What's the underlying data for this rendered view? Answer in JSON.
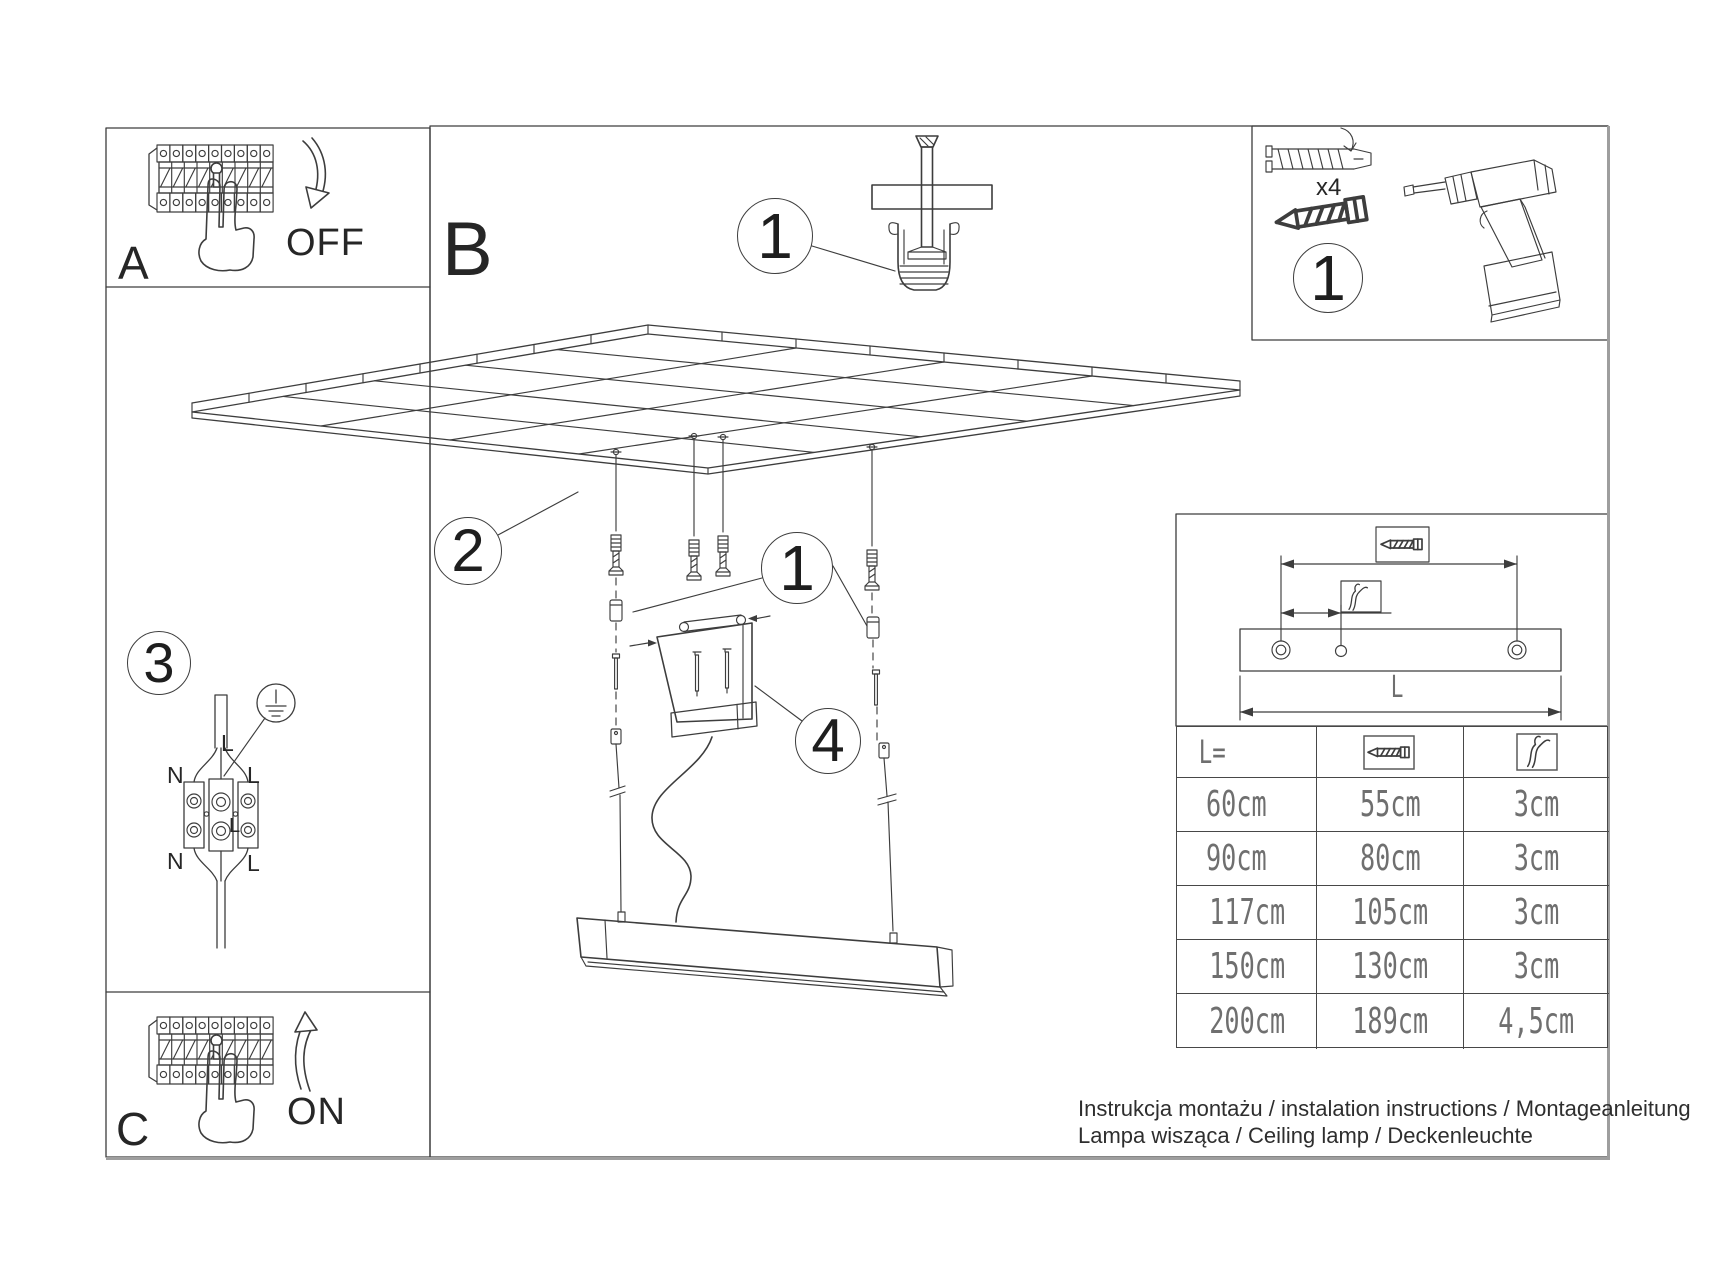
{
  "sections": {
    "a": "A",
    "b": "B",
    "c": "C"
  },
  "power": {
    "off": "OFF",
    "on": "ON"
  },
  "callouts": {
    "ceiling_anchor": "1",
    "mounting_kit": "1",
    "suspension": "1",
    "grid": "2",
    "wiring": "3",
    "canopy": "4"
  },
  "kit": {
    "dowel_qty": "x4"
  },
  "wiring": {
    "top_left": "N",
    "top_right": "L",
    "cable": "L",
    "center": "L",
    "bottom_left": "N",
    "bottom_right": "L"
  },
  "bracket": {
    "length_label": "L"
  },
  "table": {
    "header_length": "L=",
    "rows": [
      {
        "length": "60cm",
        "screw_distance": "55cm",
        "strip_length": "3cm"
      },
      {
        "length": "90cm",
        "screw_distance": "80cm",
        "strip_length": "3cm"
      },
      {
        "length": "117cm",
        "screw_distance": "105cm",
        "strip_length": "3cm"
      },
      {
        "length": "150cm",
        "screw_distance": "130cm",
        "strip_length": "3cm"
      },
      {
        "length": "200cm",
        "screw_distance": "189cm",
        "strip_length": "4,5cm"
      }
    ]
  },
  "footer": {
    "line1": "Instrukcja montażu / instalation instructions / Montageanleitung",
    "line2": "Lampa wisząca / Ceiling lamp / Deckenleuchte"
  },
  "colors": {
    "ink": "#3d3d3d",
    "cad_text": "#6f6f6f",
    "page_edge": "#9e9e9e"
  }
}
